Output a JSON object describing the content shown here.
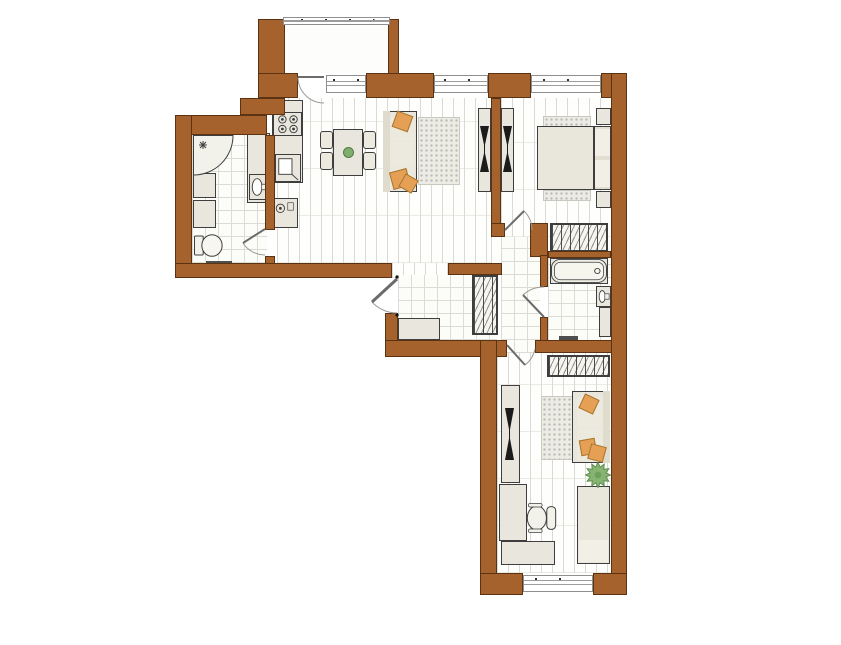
{
  "title": "apartment-floor-plan",
  "colors": {
    "wall": "#a6622c",
    "wall_line": "#5b3312",
    "outline": "#3e3e3e",
    "furniture_fill": "#e9e7dd",
    "accent_orange": "#e5a055",
    "plant_green": "#86b473",
    "floor_line": "#dadad5",
    "tile_line": "#dcdcd7",
    "rug_dot": "#bdbdb6",
    "glass_line": "#9c9c9c"
  },
  "plan": {
    "width": 841,
    "height": 645,
    "floors": [
      {
        "n": "balcony-floor",
        "k": "plain",
        "r": [
          285,
          25,
          103,
          48
        ]
      },
      {
        "n": "kitchen-living-floor",
        "k": "plank",
        "r": [
          277,
          98,
          214,
          165
        ]
      },
      {
        "n": "living-gap-floor",
        "k": "plank",
        "r": [
          392,
          263,
          56,
          15
        ]
      },
      {
        "n": "living-nook-floor",
        "k": "plank",
        "r": [
          491,
          237,
          10,
          28
        ]
      },
      {
        "n": "bedroom1-floor",
        "k": "plank",
        "r": [
          501,
          98,
          110,
          139
        ]
      },
      {
        "n": "bedroom2-floor",
        "k": "plank",
        "r": [
          497,
          353,
          114,
          220
        ]
      },
      {
        "n": "bathroom1-floor",
        "k": "tile",
        "r": [
          192,
          135,
          75,
          128
        ]
      },
      {
        "n": "entrance-hall-floor",
        "k": "tile",
        "r": [
          398,
          275,
          99,
          65
        ]
      },
      {
        "n": "corridor-floor",
        "k": "tile",
        "r": [
          501,
          237,
          39,
          116
        ]
      },
      {
        "n": "bathroom2-floor",
        "k": "tile",
        "r": [
          548,
          258,
          63,
          85
        ]
      }
    ],
    "walls": [
      {
        "n": "balcony-wall-left",
        "r": [
          258,
          19,
          27,
          83
        ]
      },
      {
        "n": "balcony-wall-right",
        "r": [
          388,
          19,
          11,
          58
        ]
      },
      {
        "n": "north-wall-a",
        "r": [
          258,
          73,
          40,
          25
        ]
      },
      {
        "n": "north-wall-b",
        "r": [
          366,
          73,
          68,
          25
        ]
      },
      {
        "n": "north-wall-pier",
        "r": [
          488,
          73,
          43,
          25
        ]
      },
      {
        "n": "north-wall-corner",
        "r": [
          601,
          73,
          26,
          25
        ]
      },
      {
        "n": "east-wall",
        "r": [
          611,
          73,
          16,
          522
        ]
      },
      {
        "n": "kitchen-nw-wall",
        "r": [
          240,
          98,
          45,
          17
        ]
      },
      {
        "n": "bathroom1-north-wall",
        "r": [
          175,
          115,
          92,
          20
        ]
      },
      {
        "n": "west-wall",
        "r": [
          175,
          115,
          17,
          163
        ]
      },
      {
        "n": "bathroom1-east-wall",
        "r": [
          265,
          135,
          10,
          95
        ]
      },
      {
        "n": "bathroom1-east-stub",
        "r": [
          265,
          256,
          10,
          22
        ]
      },
      {
        "n": "south-wall-west-wing",
        "r": [
          175,
          263,
          217,
          15
        ]
      },
      {
        "n": "hall-west-wall",
        "r": [
          385,
          313,
          13,
          44
        ]
      },
      {
        "n": "hall-south-wall",
        "r": [
          385,
          340,
          122,
          17
        ]
      },
      {
        "n": "living-hall-wall",
        "r": [
          448,
          263,
          54,
          12
        ]
      },
      {
        "n": "living-bedroom1-partition",
        "r": [
          491,
          98,
          10,
          130
        ]
      },
      {
        "n": "bedroom1-door-corner",
        "r": [
          491,
          223,
          14,
          14
        ]
      },
      {
        "n": "bedroom1-south-block",
        "r": [
          530,
          223,
          18,
          34
        ]
      },
      {
        "n": "bathroom2-north-wall",
        "r": [
          548,
          251,
          63,
          7
        ]
      },
      {
        "n": "bathroom2-west-upper",
        "r": [
          540,
          255,
          8,
          32
        ]
      },
      {
        "n": "bathroom2-west-lower",
        "r": [
          540,
          317,
          8,
          26
        ]
      },
      {
        "n": "bathroom2-south-wall",
        "r": [
          535,
          340,
          77,
          13
        ]
      },
      {
        "n": "wing-west-wall",
        "r": [
          480,
          340,
          17,
          255
        ]
      },
      {
        "n": "south-wall-a",
        "r": [
          480,
          573,
          43,
          22
        ]
      },
      {
        "n": "south-wall-b",
        "r": [
          593,
          573,
          34,
          22
        ]
      }
    ],
    "windows": [
      {
        "n": "balcony-window",
        "r": [
          283,
          17,
          107,
          8
        ]
      },
      {
        "n": "kitchen-window",
        "r": [
          326,
          75,
          40,
          18
        ]
      },
      {
        "n": "living-window",
        "r": [
          434,
          75,
          54,
          18
        ]
      },
      {
        "n": "bedroom1-window",
        "r": [
          531,
          75,
          70,
          18
        ]
      },
      {
        "n": "bedroom2-window",
        "r": [
          523,
          575,
          70,
          17
        ]
      }
    ],
    "doors": [
      {
        "n": "balcony-door",
        "r": [
          296,
          70,
          34,
          36
        ],
        "leaf": [
          2,
          7,
          28,
          7
        ],
        "arc": "M2 7 A26 26 0 0 0 28 33"
      },
      {
        "n": "bathroom1-door",
        "r": [
          242,
          226,
          34,
          34
        ],
        "leaf": [
          23,
          3,
          1,
          17
        ],
        "arc": "M23 29 A26 26 0 0 1 1 17"
      },
      {
        "n": "bedroom1-door",
        "r": [
          500,
          200,
          36,
          36
        ],
        "leaf": [
          5,
          30,
          24,
          11
        ],
        "arc": "M32 30 A27 27 0 0 0 24 11"
      },
      {
        "n": "bathroom2-door",
        "r": [
          520,
          284,
          30,
          36
        ],
        "leaf": [
          24,
          33,
          3,
          11
        ],
        "arc": "M24 3 A30 30 0 0 0 3 11"
      },
      {
        "n": "bedroom2-door",
        "r": [
          502,
          341,
          38,
          38
        ],
        "leaf": [
          5,
          4,
          23,
          24
        ],
        "arc": "M33 8 A27 27 0 0 1 23 24"
      },
      {
        "n": "entry-door",
        "r": [
          360,
          274,
          42,
          44
        ],
        "leaf": [
          37,
          5,
          12,
          28
        ],
        "arc": "M37 39 A34 34 0 0 1 12 28",
        "thick": true
      }
    ],
    "items": [
      {
        "n": "living-rug",
        "k": "rug",
        "r": [
          418,
          117,
          42,
          68
        ]
      },
      {
        "n": "bedroom1-rug-top",
        "k": "rug",
        "r": [
          543,
          116,
          48,
          11
        ]
      },
      {
        "n": "bedroom1-rug-bottom",
        "k": "rug",
        "r": [
          543,
          190,
          48,
          11
        ]
      },
      {
        "n": "bedroom2-rug",
        "k": "rug",
        "r": [
          541,
          396,
          32,
          64
        ]
      },
      {
        "n": "kitchen-counter",
        "k": "counter",
        "r": [
          272,
          100,
          31,
          83
        ]
      },
      {
        "n": "stove",
        "k": "stove",
        "r": [
          273,
          112,
          29,
          24
        ]
      },
      {
        "n": "kitchen-sink-unit",
        "k": "ksink",
        "r": [
          275,
          154,
          26,
          28
        ]
      },
      {
        "n": "washing-machine",
        "k": "washer",
        "r": [
          272,
          198,
          26,
          30
        ]
      },
      {
        "n": "corner-shower",
        "k": "shower",
        "r": [
          193,
          135,
          41,
          41
        ]
      },
      {
        "n": "bathroom1-cabinet-a",
        "k": "cabinet",
        "r": [
          193,
          173,
          23,
          25
        ]
      },
      {
        "n": "bathroom1-cabinet-b",
        "k": "cabinet",
        "r": [
          193,
          200,
          23,
          28
        ]
      },
      {
        "n": "toilet",
        "k": "toilet",
        "r": [
          194,
          232,
          29,
          27
        ]
      },
      {
        "n": "bathroom1-mat",
        "k": "mat",
        "r": [
          206,
          261,
          26,
          4
        ]
      },
      {
        "n": "bathroom1-vanity",
        "k": "cabinet",
        "r": [
          247,
          133,
          23,
          70
        ]
      },
      {
        "n": "bathroom1-sink",
        "k": "sink",
        "r": [
          249,
          174,
          19,
          26
        ]
      },
      {
        "n": "dining-table",
        "k": "table",
        "r": [
          333,
          129,
          30,
          47
        ]
      },
      {
        "n": "table-centerpiece",
        "k": "dot",
        "r": [
          343,
          147,
          11,
          11
        ]
      },
      {
        "n": "dining-chair-1",
        "k": "chair",
        "r": [
          320,
          131,
          13,
          18
        ]
      },
      {
        "n": "dining-chair-2",
        "k": "chair",
        "r": [
          320,
          152,
          13,
          18
        ]
      },
      {
        "n": "dining-chair-3",
        "k": "chair",
        "r": [
          363,
          131,
          13,
          18
        ]
      },
      {
        "n": "dining-chair-4",
        "k": "chair",
        "r": [
          363,
          152,
          13,
          18
        ]
      },
      {
        "n": "living-sofa",
        "k": "sofa",
        "r": [
          383,
          111,
          34,
          81
        ]
      },
      {
        "n": "living-sofa-back",
        "k": "sofaback",
        "r": [
          383,
          111,
          7,
          81
        ]
      },
      {
        "n": "living-sofa-cushion-1",
        "k": "cushion",
        "r": [
          390,
          117,
          24,
          24
        ]
      },
      {
        "n": "living-sofa-cushion-2",
        "k": "cushion",
        "r": [
          390,
          142,
          24,
          24
        ]
      },
      {
        "n": "living-sofa-cushion-3",
        "k": "cushion",
        "r": [
          390,
          167,
          24,
          22
        ]
      },
      {
        "n": "living-pillow-1",
        "k": "apillow",
        "r": [
          394,
          113,
          17,
          17
        ],
        "rot": 20
      },
      {
        "n": "living-pillow-2",
        "k": "apillow",
        "r": [
          391,
          170,
          18,
          18
        ],
        "rot": -15
      },
      {
        "n": "living-pillow-3",
        "k": "apillow",
        "r": [
          401,
          176,
          15,
          15
        ],
        "rot": 30
      },
      {
        "n": "living-tv-stand",
        "k": "cabinet",
        "r": [
          478,
          108,
          13,
          84
        ]
      },
      {
        "n": "living-tv",
        "k": "tv",
        "r": [
          480,
          126,
          9,
          46
        ]
      },
      {
        "n": "bedroom1-tv-stand",
        "k": "cabinet",
        "r": [
          501,
          108,
          13,
          84
        ]
      },
      {
        "n": "bedroom1-tv",
        "k": "tv",
        "r": [
          503,
          126,
          9,
          46
        ]
      },
      {
        "n": "double-bed-headboard",
        "k": "bedhead",
        "r": [
          594,
          126,
          17,
          64
        ]
      },
      {
        "n": "double-bed",
        "k": "bedframe",
        "r": [
          537,
          126,
          57,
          64
        ]
      },
      {
        "n": "double-bed-pillow-a",
        "k": "pillow",
        "r": [
          595,
          129,
          15,
          27
        ]
      },
      {
        "n": "double-bed-pillow-b",
        "k": "pillow",
        "r": [
          595,
          160,
          15,
          27
        ]
      },
      {
        "n": "nightstand-a",
        "k": "cabinet",
        "r": [
          596,
          108,
          15,
          17
        ]
      },
      {
        "n": "nightstand-b",
        "k": "cabinet",
        "r": [
          596,
          191,
          15,
          17
        ]
      },
      {
        "n": "bedroom1-wardrobe",
        "k": "wardrobe",
        "r": [
          550,
          223,
          58,
          29
        ]
      },
      {
        "n": "hall-bench",
        "k": "bench",
        "r": [
          398,
          318,
          42,
          22
        ]
      },
      {
        "n": "hall-wardrobe",
        "k": "wardrobe",
        "r": [
          472,
          275,
          26,
          60
        ]
      },
      {
        "n": "bathtub",
        "k": "tub",
        "r": [
          550,
          258,
          58,
          26
        ]
      },
      {
        "n": "bathroom2-sink",
        "k": "sink",
        "r": [
          596,
          286,
          15,
          21
        ]
      },
      {
        "n": "bathroom2-cabinet",
        "k": "cabinet",
        "r": [
          599,
          307,
          12,
          30
        ]
      },
      {
        "n": "bathroom2-mat",
        "k": "mat",
        "r": [
          559,
          336,
          19,
          4
        ]
      },
      {
        "n": "bedroom2-wardrobe",
        "k": "wardrobe",
        "r": [
          547,
          355,
          63,
          22
        ]
      },
      {
        "n": "bedroom2-tv-stand",
        "k": "cabinet",
        "r": [
          501,
          385,
          19,
          98
        ]
      },
      {
        "n": "bedroom2-tv",
        "k": "tv",
        "r": [
          505,
          408,
          9,
          52
        ]
      },
      {
        "n": "bedroom2-sofa",
        "k": "sofa",
        "r": [
          572,
          391,
          38,
          72
        ]
      },
      {
        "n": "bedroom2-sofa-back",
        "k": "sofaback",
        "r": [
          603,
          391,
          7,
          72
        ]
      },
      {
        "n": "bedroom2-sofa-cushion-1",
        "k": "cushion",
        "r": [
          577,
          397,
          26,
          31
        ]
      },
      {
        "n": "bedroom2-sofa-cushion-2",
        "k": "cushion",
        "r": [
          577,
          429,
          26,
          31
        ]
      },
      {
        "n": "bedroom2-pillow-1",
        "k": "apillow",
        "r": [
          581,
          396,
          16,
          16
        ],
        "rot": 25
      },
      {
        "n": "bedroom2-pillow-2",
        "k": "apillow",
        "r": [
          580,
          439,
          16,
          16
        ],
        "rot": -10
      },
      {
        "n": "bedroom2-pillow-3",
        "k": "apillow",
        "r": [
          589,
          445,
          16,
          16
        ],
        "rot": 15
      },
      {
        "n": "plant",
        "k": "plant",
        "r": [
          585,
          462,
          26,
          26
        ]
      },
      {
        "n": "desk-vertical",
        "k": "desk",
        "r": [
          499,
          484,
          28,
          57
        ]
      },
      {
        "n": "desk-horizontal",
        "k": "desk",
        "r": [
          501,
          541,
          54,
          24
        ]
      },
      {
        "n": "office-chair",
        "k": "ochair",
        "r": [
          525,
          503,
          33,
          30
        ]
      },
      {
        "n": "single-bed",
        "k": "bedframe",
        "r": [
          577,
          486,
          33,
          78
        ]
      },
      {
        "n": "single-bed-pillow",
        "k": "pillow",
        "r": [
          579,
          540,
          29,
          22
        ]
      }
    ]
  }
}
